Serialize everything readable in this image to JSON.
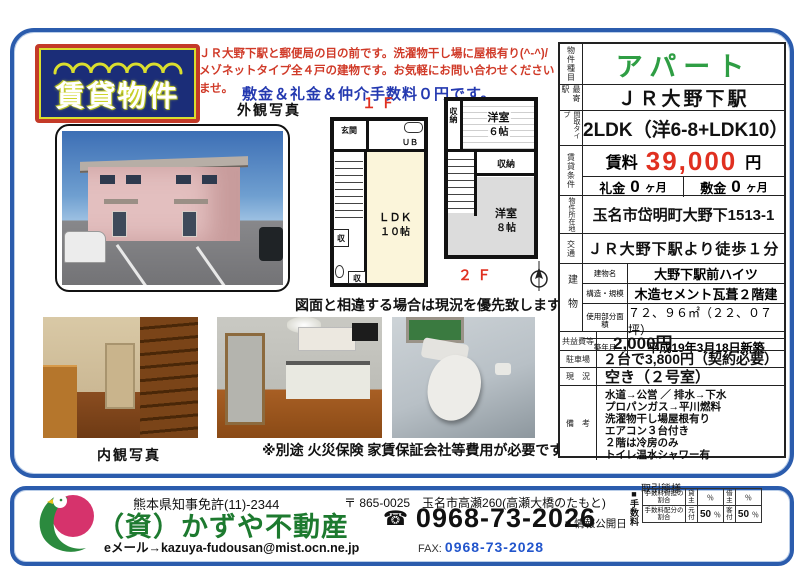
{
  "logo": {
    "text": "賃貸物件"
  },
  "promo": {
    "line1": "ＪＲ大野下駅と郵便局の目の前です。洗濯物干し場に屋根有り(^-^)/",
    "line2": "メゾネットタイプ全４戸の建物です。お気軽にお問い合わせくださいませ。",
    "highlight": "敷金＆礼金＆仲介手数料０円です。"
  },
  "photos": {
    "exterior_label": "外観写真",
    "interior_label": "内観写真"
  },
  "disclaimers": {
    "plan": "図面と相違する場合は現況を優先致します。",
    "fees": "※別途 火災保険 家賃保証会社等費用が必要です"
  },
  "floorplan": {
    "floor1": "１Ｆ",
    "floor2": "２Ｆ",
    "genkan": "玄関",
    "ub": "ＵＢ",
    "ldk_name": "ＬＤＫ",
    "ldk_size": "１０帖",
    "closet1": "収",
    "closet2": "収",
    "storage1": "収納",
    "storage2": "収納",
    "room6_name": "洋室",
    "room6_size": "６帖",
    "room8_name": "洋室",
    "room8_size": "８帖"
  },
  "property": {
    "type_label": "物件種目",
    "type_value": "アパート",
    "station_label": "最寄駅",
    "station_value": "ＪＲ大野下駅",
    "layout_label": "間取タイプ",
    "layout_value": "2LDK（洋6-8+LDK10）",
    "terms_label": "賃貸条件",
    "rent_label": "賃料",
    "rent_value": "39,000",
    "rent_unit": "円",
    "reikin_label": "礼金",
    "reikin_value": "0",
    "reikin_unit": "ヶ月",
    "shikikin_label": "敷金",
    "shikikin_value": "0",
    "shikikin_unit": "ヶ月",
    "address_label": "物件所在地",
    "address_value": "玉名市岱明町大野下1513-1",
    "access_label": "交通",
    "access_value": "ＪＲ大野下駅より徒歩１分",
    "building_label": "建物",
    "building_rows": [
      {
        "label": "建物名",
        "value": "大野下駅前ハイツ"
      },
      {
        "label": "構造・規模",
        "value": "木造セメント瓦葺２階建"
      },
      {
        "label": "使用部分面積",
        "value": "７２、９６㎡（２２、０７坪）"
      },
      {
        "label": "築年月",
        "value": "平成19年3月18日新築"
      }
    ],
    "fee_label": "共益費等",
    "fee_value": "2,000円",
    "parking_label": "駐車場",
    "parking_value": "２台で3,800円（契約必要）",
    "status_label": "現　況",
    "status_value": "空き（２号室）",
    "notes_label": "備　考",
    "notes": [
      "水道→公営 ／ 排水→下水",
      "プロパンガス→平川燃料",
      "洗濯物干し場屋根有り",
      "エアコン３台付き",
      "２階は冷房のみ",
      "トイレ温水シャワー有"
    ]
  },
  "footer": {
    "license": "熊本県知事免許(11)-2344",
    "company": "（資）かずや不動産",
    "email": "eメール→kazuya-fudousan@mist.ocn.ne.jp",
    "postal": "〒 865-0025　玉名市高瀬260(高瀬大橋のたもと)",
    "phone_icon": "☎",
    "phone": "0968-73-2026",
    "fax_label": "FAX:",
    "fax": "0968-73-2028",
    "dealing_label": "取引態様",
    "info_date_label": "■ 情報公開日",
    "fee_title": "■手数料",
    "fee_table": {
      "rows": [
        {
          "label": "手数料負担の割合",
          "c1": "貸主",
          "v1": "",
          "u1": "％",
          "c2": "借主",
          "v2": "",
          "u2": "％"
        },
        {
          "label": "手数料配分の割合",
          "c1": "元付",
          "v1": "50",
          "u1": "％",
          "c2": "客付",
          "v2": "50",
          "u2": "％"
        }
      ]
    }
  },
  "colors": {
    "panel_border": "#2b5cad",
    "accent_red": "#d03a28",
    "accent_blue": "#2439b0",
    "rent_red": "#e03020",
    "apart_green": "#2f9e44",
    "brand_green": "#1d7a2f",
    "logo_navy": "#1b2d78",
    "logo_border_red": "#c43a28",
    "logo_yellow": "#dade2e"
  }
}
